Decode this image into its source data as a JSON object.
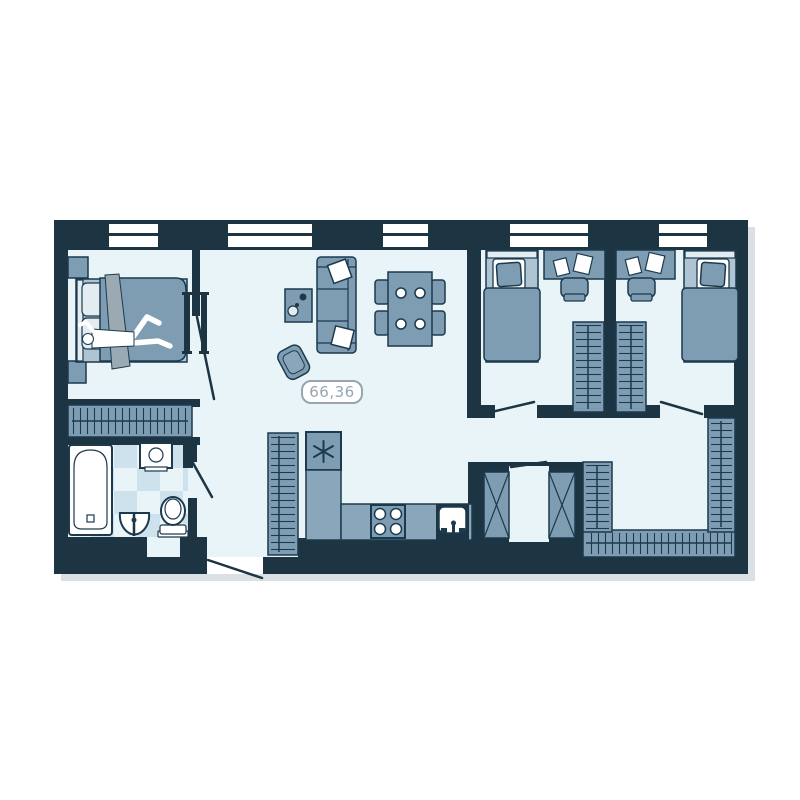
{
  "floorplan": {
    "area_label": "66,36",
    "colors": {
      "wall": "#1d3443",
      "floor": "#e8f4f8",
      "unit": "#7e9cb2",
      "counter": "#8aa6ba",
      "unit_light": "#aec4d2",
      "pale": "#e2ecf1",
      "checker": "#cde2ec",
      "outline": "#1c3a4e",
      "drape": "#9aa9b2",
      "label": "#97a5b1",
      "shadow": "#dae0e4"
    },
    "icons": [
      {
        "name": "snowflake-icon",
        "meaning": "refrigerator"
      },
      {
        "name": "hanger-hatch",
        "meaning": "wardrobe with hangers"
      },
      {
        "name": "x-cross",
        "meaning": "ventilation shaft"
      }
    ],
    "rooms": [
      {
        "name": "master-bedroom",
        "furniture": [
          "double-bed-with-person",
          "nightstand",
          "nightstand",
          "wall-tv",
          "wardrobe"
        ]
      },
      {
        "name": "living-dining",
        "furniture": [
          "sofa",
          "pillow",
          "pillow",
          "coffee-table",
          "armchair",
          "dining-table",
          "chair",
          "chair",
          "chair",
          "chair",
          "wall-tv"
        ]
      },
      {
        "name": "bathroom",
        "furniture": [
          "bathtub",
          "washing-machine",
          "sink",
          "toilet"
        ]
      },
      {
        "name": "kitchen",
        "furniture": [
          "wardrobe",
          "refrigerator",
          "l-counter",
          "stove-4-burners",
          "kitchen-sink"
        ]
      },
      {
        "name": "kid-bedroom-left",
        "furniture": [
          "single-bed",
          "desk",
          "chair",
          "papers",
          "wardrobe"
        ]
      },
      {
        "name": "kid-bedroom-right",
        "furniture": [
          "single-bed",
          "desk",
          "chair",
          "papers",
          "wardrobe"
        ]
      },
      {
        "name": "hallway-dressing",
        "furniture": [
          "u-shaped-wardrobe"
        ]
      },
      {
        "name": "shaft-niche",
        "furniture": [
          "duct",
          "duct"
        ]
      }
    ],
    "windows_count": 5,
    "doors_count": 6
  }
}
